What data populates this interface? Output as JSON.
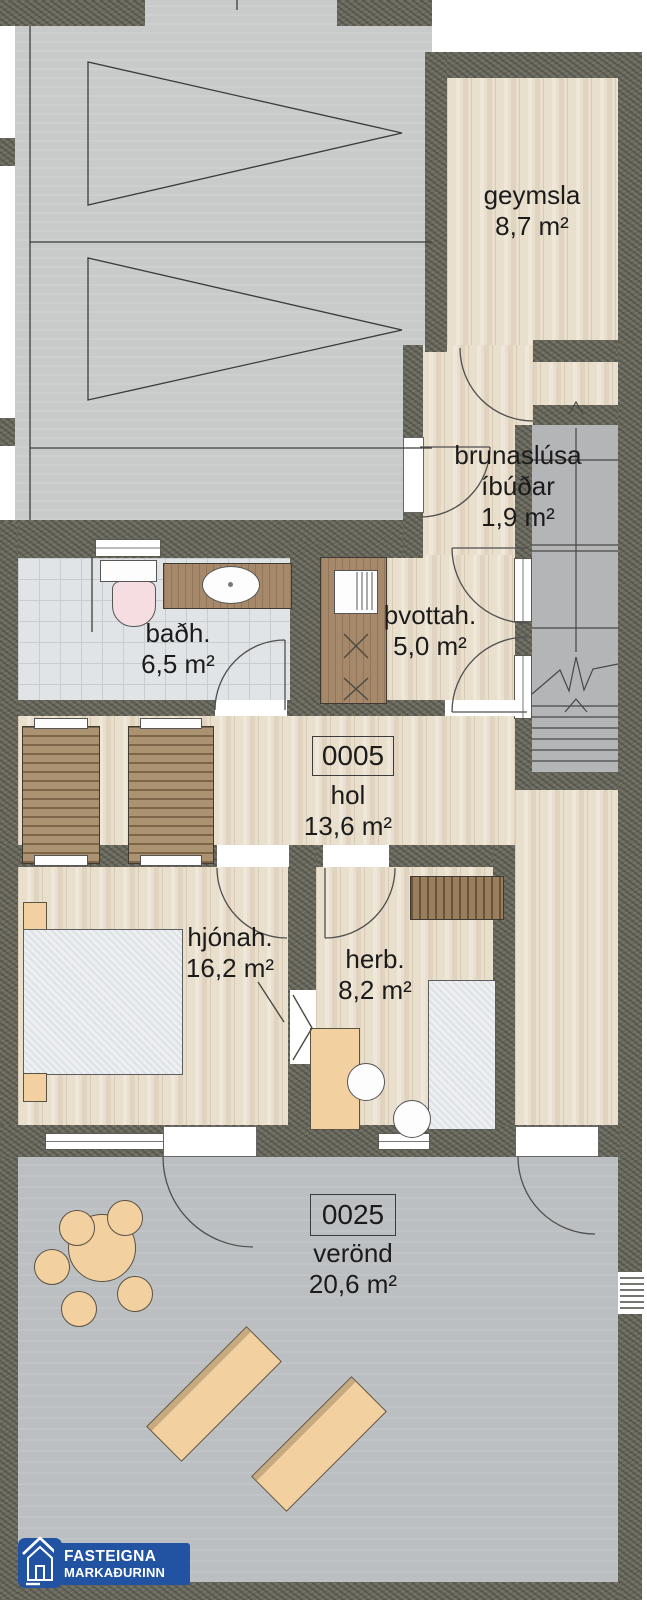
{
  "plan": {
    "rooms": {
      "geymsla": {
        "name": "geymsla",
        "area": "8,7 m²"
      },
      "brunaslusa": {
        "name_line1": "brunaslúsa",
        "name_line2": "íbúðar",
        "area": "1,9 m²"
      },
      "thvottahus": {
        "name": "þvottah.",
        "area": "5,0 m²"
      },
      "badherbergi": {
        "name": "baðh.",
        "area": "6,5 m²"
      },
      "hol": {
        "unit_number": "0005",
        "name": "hol",
        "area": "13,6 m²"
      },
      "hjonaherbergi": {
        "name": "hjónah.",
        "area": "16,2 m²"
      },
      "herbergi": {
        "name": "herb.",
        "area": "8,2 m²"
      },
      "verond": {
        "unit_number": "0025",
        "name": "verönd",
        "area": "20,6 m²"
      }
    }
  },
  "logo": {
    "line1": "FASTEIGNA",
    "line2": "MARKAÐURINN",
    "color": "#2253a3"
  },
  "colors": {
    "wall": "#6b6a5f",
    "wood_floor": "#e9dfcd",
    "tile_floor": "#e1e4e6",
    "concrete": "#c9cbca",
    "terrace": "#bcbfc1",
    "stairs": "#b3b5b7",
    "furniture_tan": "#f3d0a0",
    "furniture_wood": "#a5896a",
    "toilet_pink": "#f6dde2",
    "logo_blue": "#2253a3",
    "label_text": "#1b1b1b"
  }
}
